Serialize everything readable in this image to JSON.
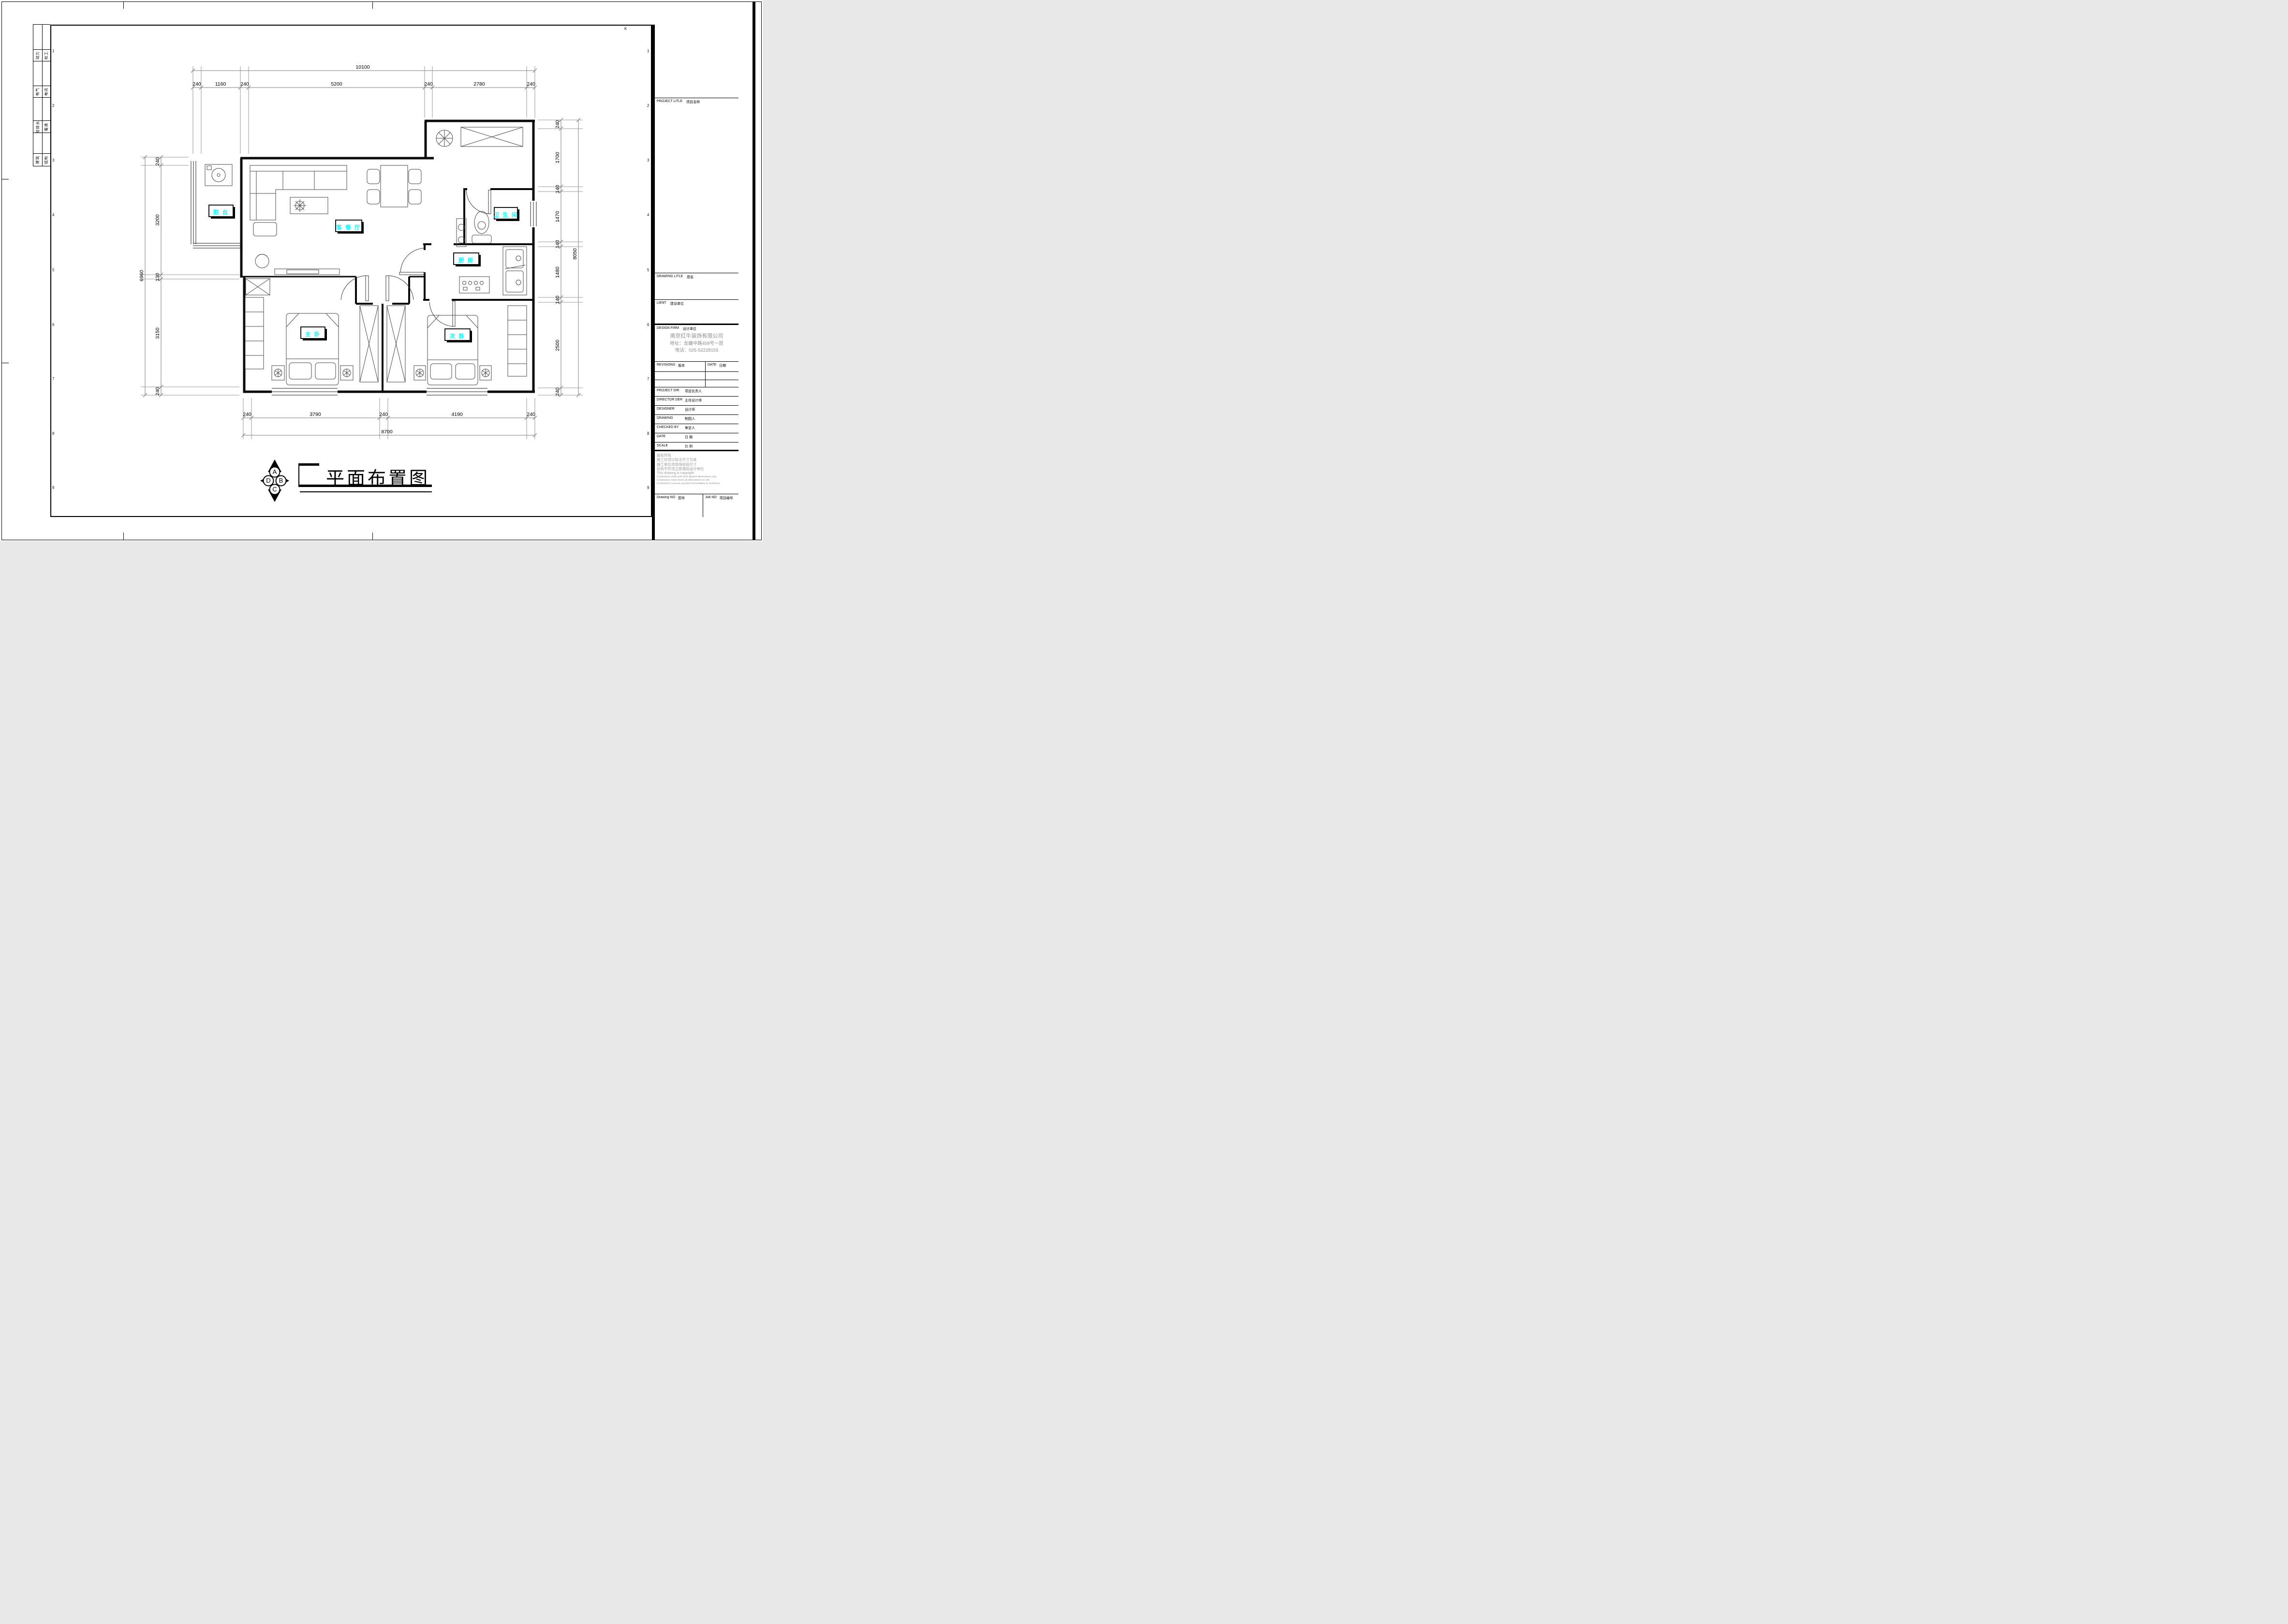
{
  "colors": {
    "room_label": "#00ffff",
    "dim_line": "#7d7d7d",
    "firm_text": "#8f8f8f"
  },
  "sheet": {
    "grid_row_numbers": [
      "1",
      "2",
      "3",
      "4",
      "5",
      "6",
      "7",
      "8",
      "9"
    ],
    "grid_col_letter": "K",
    "margin_table": {
      "rows": [
        {
          "left": "动力",
          "right": "校工"
        },
        {
          "left": "电气",
          "right": "电讯"
        },
        {
          "left": "给排水",
          "right": "暖通"
        },
        {
          "left": "建筑",
          "right": "结构"
        }
      ]
    }
  },
  "title_block": {
    "project_title_en": "PROJECT LITLE",
    "project_title_zh": "项目名称",
    "drawing_title_en": "DRAWING LITLE",
    "drawing_title_zh": "图名",
    "client_en": "LIENT",
    "client_zh": "建设单位",
    "design_firm_en": "DESIGN FIRM",
    "design_firm_zh": "设计单位",
    "firm_name": "南京红牛装饰有限公司",
    "firm_address": "地址：龙蟠中路458号一层",
    "firm_phone": "电话：025-52228155",
    "revisions_en": "REVISIONS",
    "revisions_zh": "版本",
    "date_col_en": "DATE",
    "date_col_zh": "日期",
    "rows": [
      {
        "en": "PROJECT DIR",
        "zh": "项目负责人"
      },
      {
        "en": "DIRECTOR DER",
        "zh": "主任设计师"
      },
      {
        "en": "DESIGNER",
        "zh": "设计师"
      },
      {
        "en": "DRAWING",
        "zh": "制图人"
      },
      {
        "en": "CHECKED BY",
        "zh": "审定人"
      },
      {
        "en": "DATE",
        "zh": "日  期"
      },
      {
        "en": "SCALE",
        "zh": "比  例"
      }
    ],
    "copyright": [
      "版权所有",
      "施工时须以标注尺寸为准",
      "施工单位须现场校验尺寸",
      "如有不符须立即通知设计单位",
      "This drawing is copyright",
      "Contractors shall work form figured dimensions only",
      "Contractors must check all dimensions on site",
      "Contractors must be reported immediately to architects"
    ],
    "drawing_no_en": "Drawing NO",
    "drawing_no_zh": "图号",
    "job_no_en": "Job NO",
    "job_no_zh": "项目编号"
  },
  "plan": {
    "rooms": {
      "balcony": "阳 台",
      "living": "客 餐 厅",
      "bath": "卫 生 间",
      "kitchen": "厨 房",
      "master": "主 卧",
      "second": "次 卧"
    },
    "dims": {
      "top_total": "10100",
      "top": [
        "240",
        "1160",
        "240",
        "5200",
        "240",
        "2780",
        "240"
      ],
      "bottom": [
        "240",
        "3790",
        "240",
        "4190",
        "240"
      ],
      "bottom_total": "8700",
      "left": [
        "240",
        "3200",
        "130",
        "3150",
        "240"
      ],
      "left_total": "6960",
      "right": [
        "240",
        "1700",
        "140",
        "1470",
        "140",
        "1480",
        "140",
        "2500",
        "240"
      ],
      "right_total": "8050"
    }
  },
  "footer": {
    "title": "平面布置图",
    "compass": {
      "a": "A",
      "b": "B",
      "c": "C",
      "d": "D"
    }
  }
}
